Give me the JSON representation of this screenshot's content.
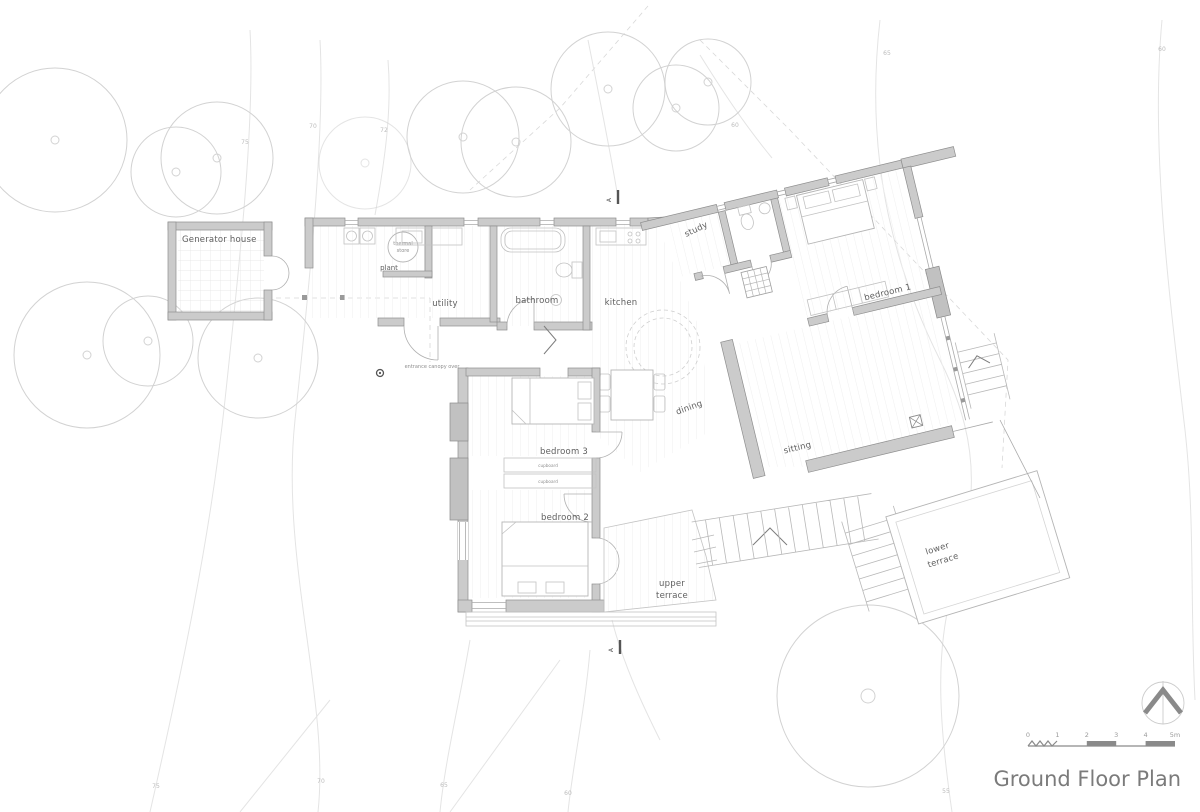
{
  "title": "Ground Floor Plan",
  "rooms": {
    "generator_house": "Generator house",
    "plant": "plant",
    "thermal_line1": "thermal",
    "thermal_line2": "store",
    "utility": "utility",
    "bathroom": "bathroom",
    "kitchen": "kitchen",
    "study": "study",
    "bedroom1": "bedroom 1",
    "bedroom3": "bedroom 3",
    "bedroom2": "bedroom 2",
    "dining": "dining",
    "sitting": "sitting",
    "upper_terrace_line1": "upper",
    "upper_terrace_line2": "terrace",
    "lower_terrace_line1": "lower",
    "lower_terrace_line2": "terrace",
    "cupboard_top": "cupboard",
    "cupboard_bottom": "cupboard"
  },
  "annotations": {
    "entrance_canopy": "entrance canopy over",
    "section_marker_top": "A",
    "section_marker_bottom": "A"
  },
  "contour_labels": [
    "75",
    "70",
    "72",
    "60",
    "65",
    "60",
    "75",
    "70",
    "65",
    "60",
    "55"
  ],
  "scale_bar": {
    "ticks": [
      "0",
      "1",
      "2",
      "3",
      "4",
      "5m"
    ]
  },
  "colors": {
    "wall_fill": "#cbcbcb",
    "wall_stroke": "#8e8e8e",
    "label": "#5f5f5f",
    "contour_line": "#e4e4e4",
    "tree_line": "#d2d2d2",
    "title_text": "#7b7b7b",
    "annotation": "#8a8a8a"
  }
}
